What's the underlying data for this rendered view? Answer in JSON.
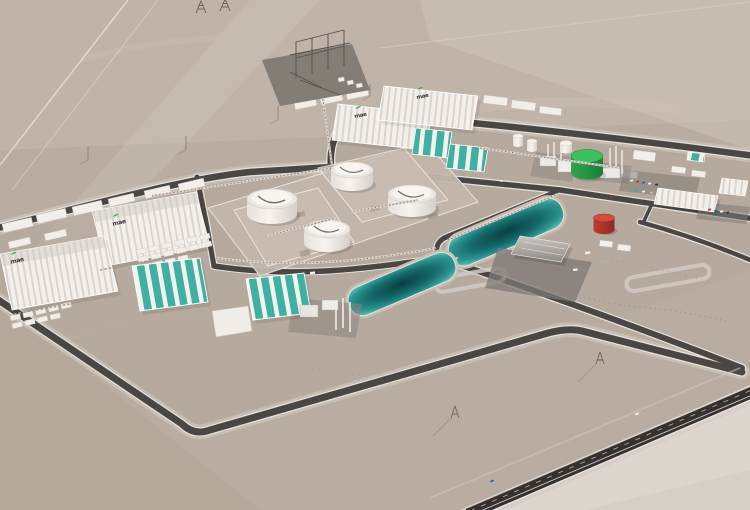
{
  "meta": {
    "title": "Aerial 3D render of a desert industrial plant complex",
    "type": "architectural-visualization",
    "view": "high oblique aerial, plant on graded pad in bare desert plain"
  },
  "logo": {
    "text": "mae",
    "accent_color": "#3aa84c",
    "note": "small dark wordmark with green swoosh painted on warehouse roofs",
    "count": 4
  },
  "colors": {
    "desert": "#b9aca0",
    "desert_light": "#d5cfc8",
    "site_pad": "#b3a699",
    "road": "#4a4643",
    "road_edge": "#e6e1db",
    "highway": "#34312e",
    "building_white": "#f3f0ec",
    "building_rib": "#d9d4ce",
    "teal": "#3fb0a1",
    "teal_dark": "#2f9487",
    "pond_center": "#0a3f41",
    "pond_edge": "#59c0b6",
    "tank_green": "#2fa64f",
    "tank_green_light": "#3dc05e",
    "tank_red": "#c0392f",
    "canopy_gray": "#a09b96",
    "substation_pad": "#837d76",
    "vehicle_palette": [
      "#f5f3ef",
      "#b5342a",
      "#2e63c0",
      "#3fae9f",
      "#333333"
    ]
  },
  "scene": {
    "terrain": "pale taupe desert with faint tracks, light streaks and pylon shadows",
    "left_block": {
      "large_ribbed_warehouses": 2,
      "roof_logos": 2,
      "small_support_buildings": 8,
      "module_rows": 2
    },
    "top_right_block": {
      "large_ribbed_warehouses": 2,
      "roof_logos": 2,
      "teal_striped_halls": 2,
      "white_silos": 2,
      "process_stacks": true
    },
    "southwest_cluster": {
      "teal_striped_halls": 2,
      "process_columns": true,
      "low_white_building": 1
    },
    "tank_farm": {
      "white_dome_tanks": 4,
      "bunded_pads": 2
    },
    "ponds": {
      "count": 2,
      "appearance": "dark teal rounded rectangles with light rims"
    },
    "utilities": {
      "green_tank": 1,
      "red_tank": 1,
      "substation": 1,
      "top_transmission_towers": 2,
      "desert_pylons": 2
    },
    "logistics": {
      "truck_loading_canopy": 1,
      "sawtooth_office_building": 1,
      "parking_lots": 2,
      "parked_cars": 13
    },
    "roads": {
      "perimeter_loop": true,
      "internal_grid": true,
      "highway": "dual carriageway with dashed lane lines, bottom right"
    }
  }
}
